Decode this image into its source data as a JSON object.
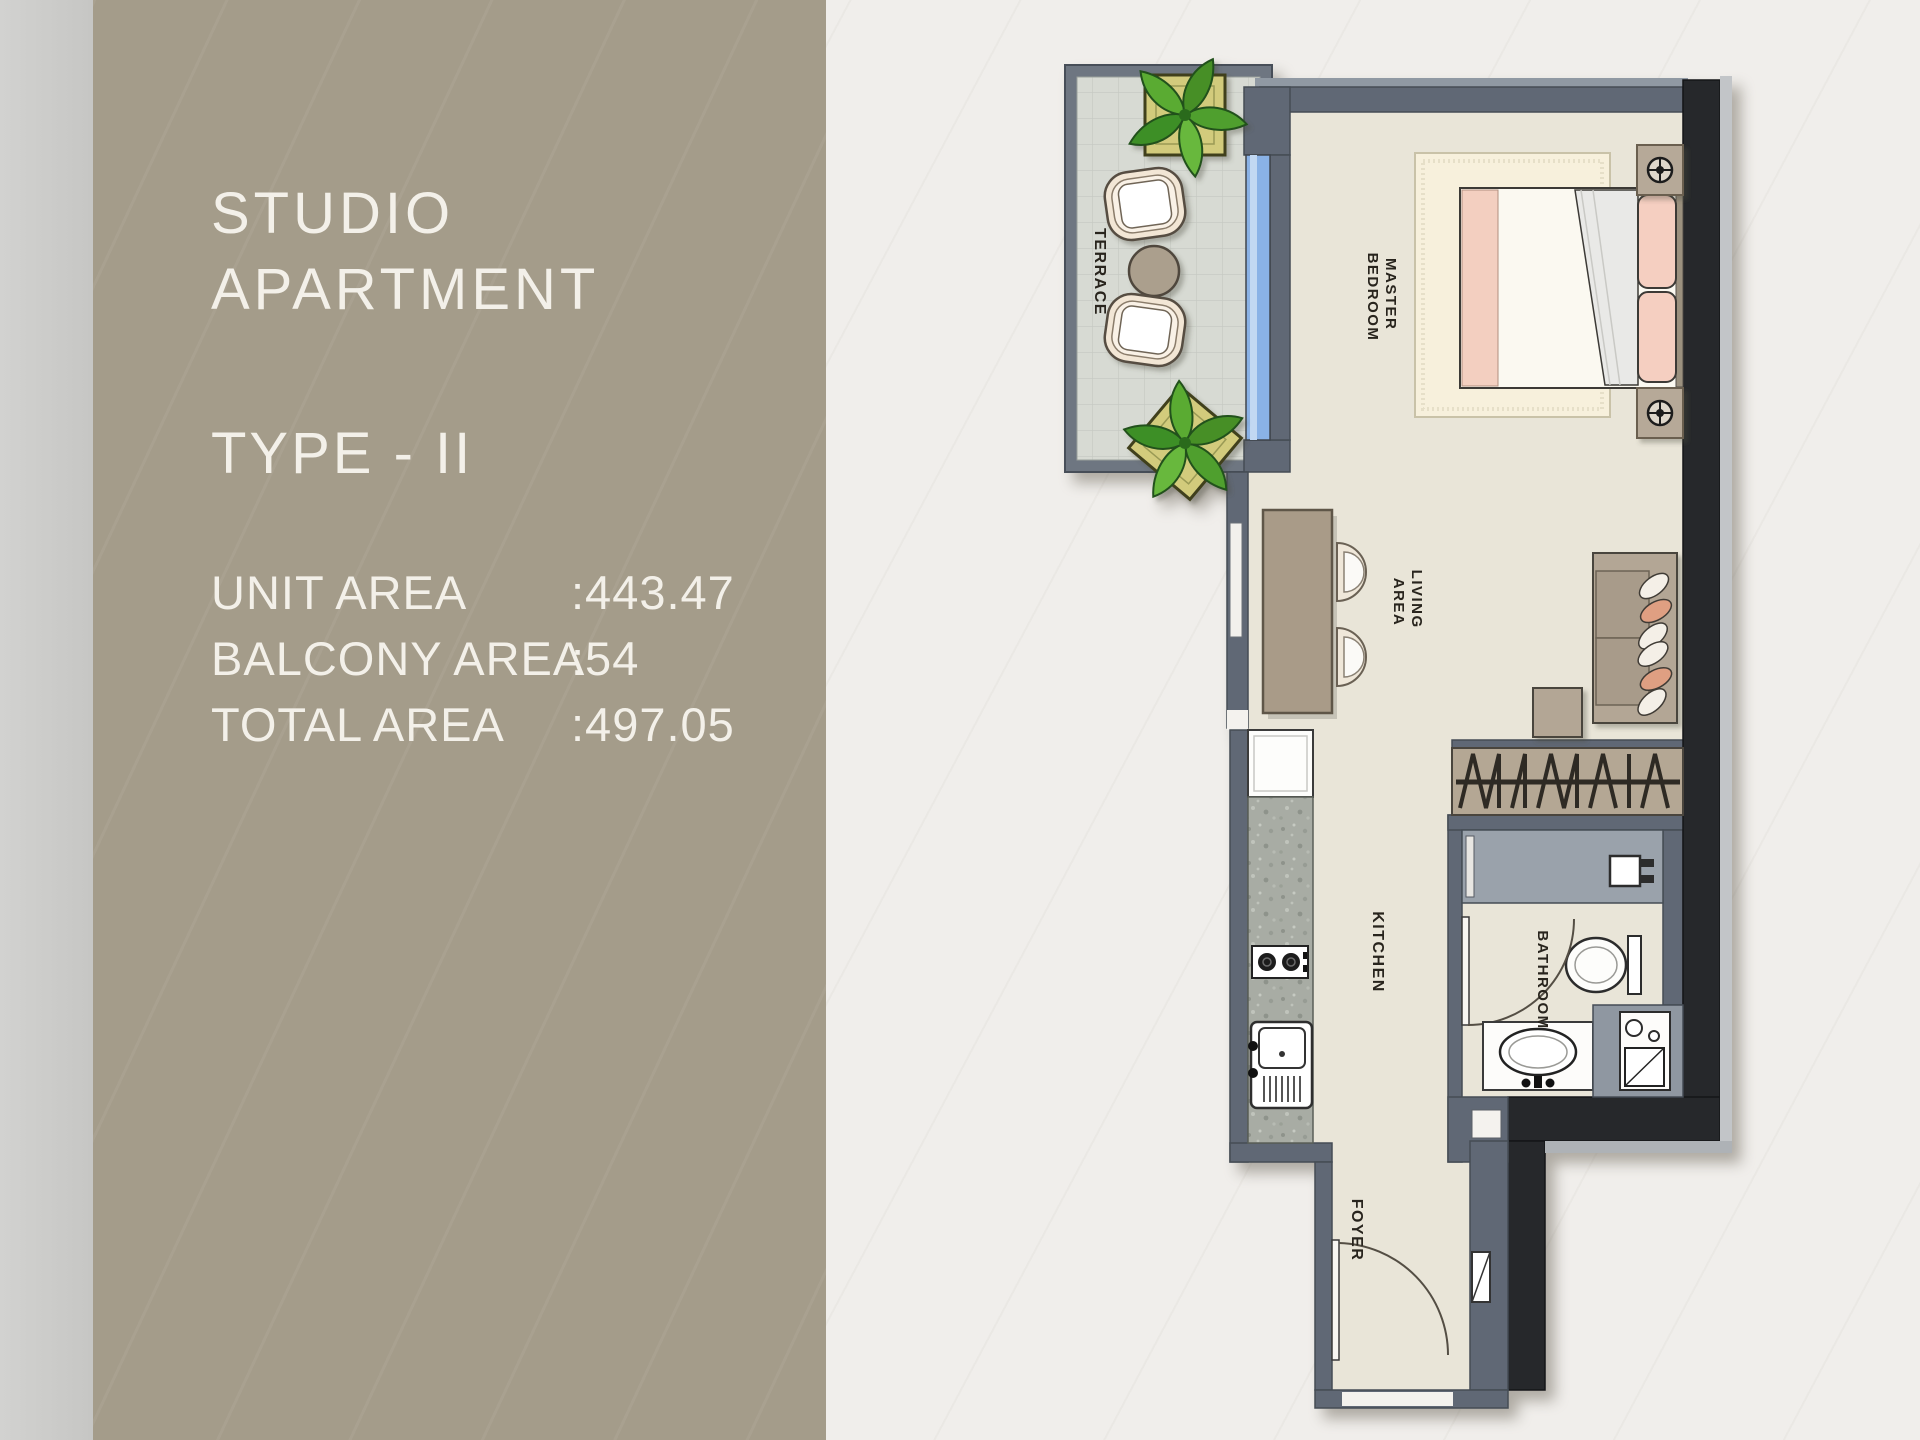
{
  "panel": {
    "title_line1": "STUDIO",
    "title_line2": "APARTMENT",
    "type_label": "TYPE - II",
    "areas": [
      {
        "label": "UNIT AREA",
        "value": ":443.47"
      },
      {
        "label": "BALCONY AREA",
        "value": ":54"
      },
      {
        "label": "TOTAL AREA",
        "value": ":497.05"
      }
    ]
  },
  "floorplan": {
    "labels": {
      "terrace": "TERRACE",
      "master_1": "MASTER",
      "master_2": "BEDROOM",
      "living_1": "LIVING",
      "living_2": "AREA",
      "kitchen": "KITCHEN",
      "bathroom": "BATHROOM",
      "foyer": "FOYER"
    },
    "colors": {
      "panel_taupe": "#a49c8a",
      "background": "#f0eeeb",
      "wall_gray": "#606875",
      "wall_black": "#26282b",
      "floor_cream": "#e9e5d8",
      "terrace_floor": "#d7dad3",
      "window_blue": "#8ab2e6",
      "furniture_tan": "#b3a695",
      "pillow_pink": "#f5cfc1",
      "plant_green": "#4f9f2e"
    }
  }
}
